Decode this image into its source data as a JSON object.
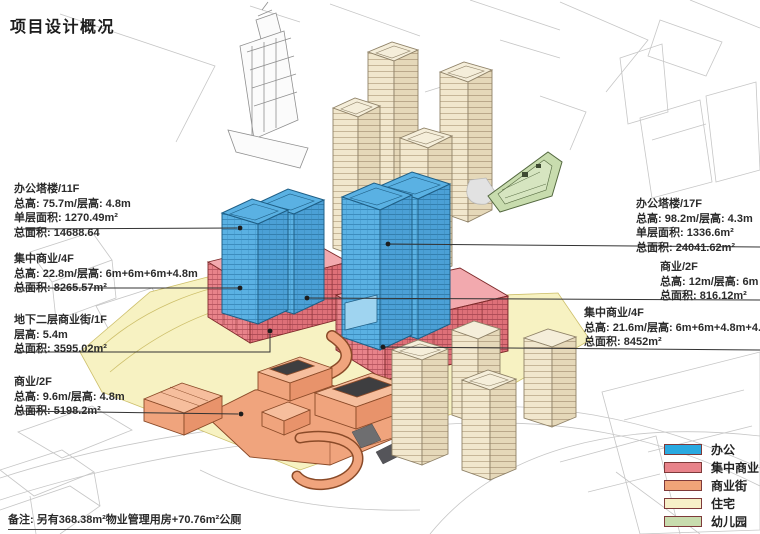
{
  "title": "项目设计概况",
  "annotations": {
    "left": [
      {
        "id": "office-tower-11f",
        "lines": [
          "办公塔楼/11F",
          "总高: 75.7m/层高: 4.8m",
          "单层面积: 1270.49m²",
          "总面积: 14688.64"
        ]
      },
      {
        "id": "central-commercial-4f-west",
        "lines": [
          "集中商业/4F",
          "总高: 22.8m/层高: 6m+6m+6m+4.8m",
          "总面积: 8265.57m²"
        ]
      },
      {
        "id": "underground-street-1f",
        "lines": [
          "地下二层商业街/1F",
          "层高: 5.4m",
          "总面积: 3595.02m²"
        ]
      },
      {
        "id": "commercial-2f-west",
        "lines": [
          "商业/2F",
          "总高: 9.6m/层高: 4.8m",
          "总面积: 5198.2m²"
        ]
      }
    ],
    "right": [
      {
        "id": "office-tower-17f",
        "lines": [
          "办公塔楼/17F",
          "总高: 98.2m/层高: 4.3m",
          "单层面积: 1336.6m²",
          "总面积: 24041.62m²"
        ]
      },
      {
        "id": "commercial-2f-east",
        "lines": [
          "商业/2F",
          "总高: 12m/层高: 6m",
          "总面积: 816.12m²"
        ]
      },
      {
        "id": "central-commercial-4f-east",
        "lines": [
          "集中商业/4F",
          "总高: 21.6m/层高: 6m+6m+4.8m+4.8m",
          "总面积: 8452m²"
        ]
      }
    ]
  },
  "legend": {
    "items": [
      {
        "label": "办公",
        "color": "#29A9E0"
      },
      {
        "label": "集中商业",
        "color": "#E8838A"
      },
      {
        "label": "商业街",
        "color": "#F0A478"
      },
      {
        "label": "住宅",
        "color": "#F7F0C8"
      },
      {
        "label": "幼儿园",
        "color": "#C8DCAE"
      }
    ]
  },
  "note": "备注: 另有368.38m²物业管理用房+70.76m²公厕",
  "colors": {
    "office-blue": "#58B0E2",
    "central-commercial-red": "#E8838A",
    "commercial-street-orange": "#F0A47D",
    "residential-tan": "#F1E7CD",
    "kindergarten-green": "#C8DCAE",
    "site-yellow": "#F7F2C2",
    "leader-line": "#333333"
  }
}
